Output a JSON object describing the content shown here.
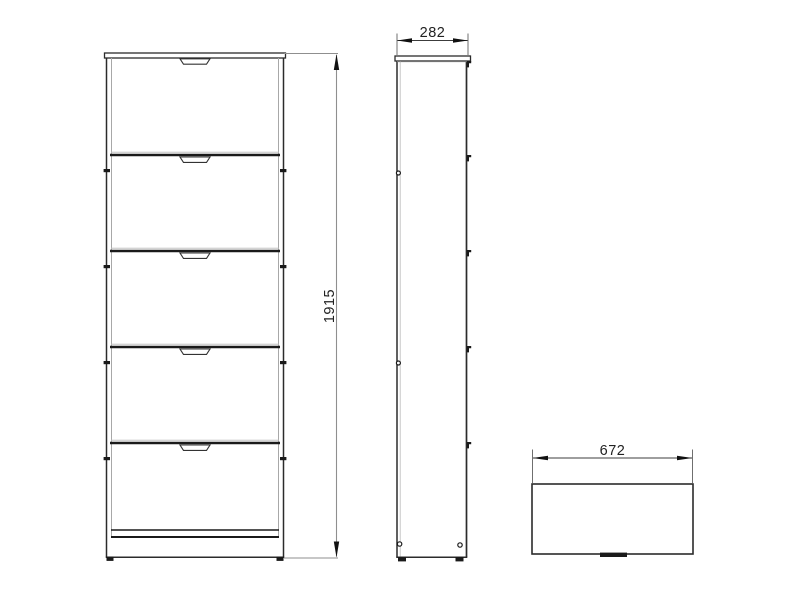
{
  "drawing": {
    "type": "furniture-technical-drawing",
    "views": [
      {
        "id": "front",
        "label": "front-view",
        "drawer_count": 5
      },
      {
        "id": "side",
        "label": "side-view"
      },
      {
        "id": "top",
        "label": "top-view"
      }
    ],
    "dimensions": {
      "height_mm": "1915",
      "depth_mm": "282",
      "width_mm": "672"
    },
    "colors": {
      "background": "#ffffff",
      "outline": "#2b2b2b",
      "divider": "#1a1a1a",
      "thin_line": "#a8a8a8",
      "dim_line_gray": "#8f8f8f",
      "dim_line_dark": "#3c3c3c",
      "label_text": "#222222"
    }
  }
}
